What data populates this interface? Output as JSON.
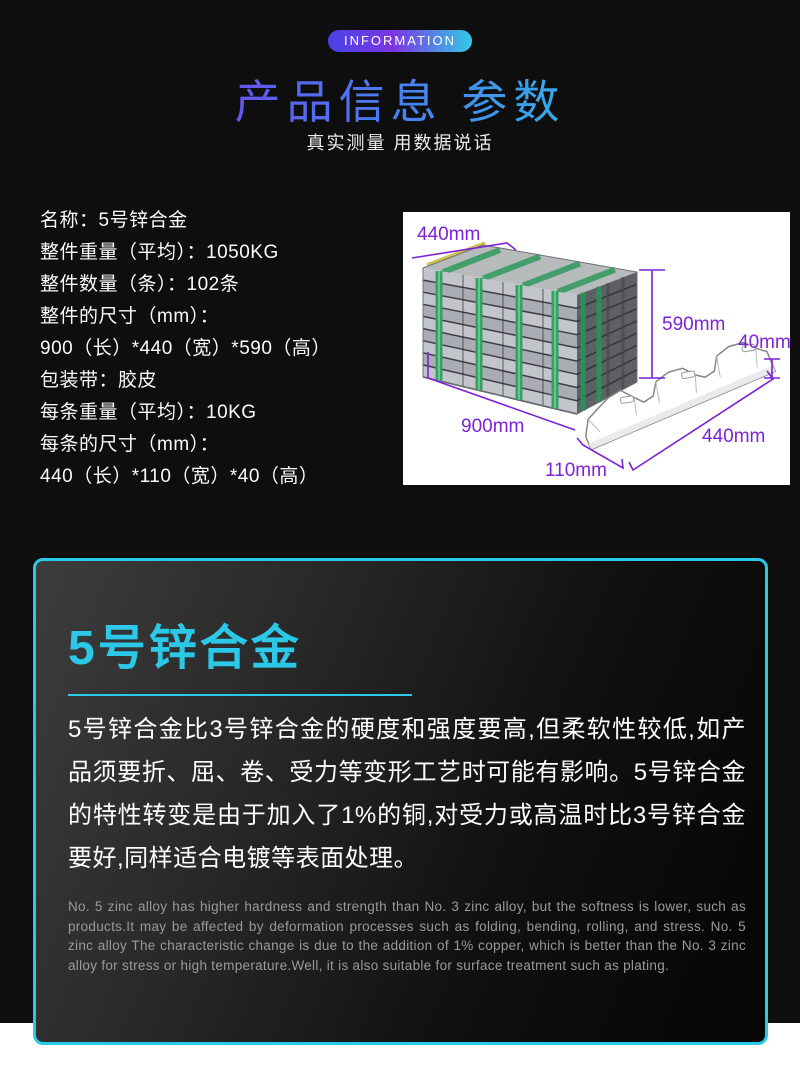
{
  "header": {
    "badge": "INFORMATION",
    "title": "产品信息 参数",
    "subtitle": "真实测量 用数据说话"
  },
  "specs": {
    "lines": [
      "名称：5号锌合金",
      "整件重量（平均）：1050KG",
      "整件数量（条）：102条",
      "整件的尺寸（mm）：",
      "900（长）*440（宽）*590（高）",
      "包装带：胶皮",
      "每条重量（平均）：10KG",
      "每条的尺寸（mm）：",
      "440（长）*110（宽）*40（高）"
    ]
  },
  "figure": {
    "labels": {
      "pack_width": "440mm",
      "pack_height": "590mm",
      "bar_height": "40mm",
      "pack_length": "900mm",
      "bar_length": "440mm",
      "bar_width": "110mm"
    }
  },
  "card": {
    "heading": "5号锌合金",
    "body_zh": "5号锌合金比3号锌合金的硬度和强度要高,但柔软性较低,如产品须要折、屈、卷、受力等变形工艺时可能有影响。5号锌合金的特性转变是由于加入了1%的铜,对受力或高温时比3号锌合金要好,同样适合电镀等表面处理。",
    "body_en": "No. 5 zinc alloy has higher hardness and strength than No. 3 zinc alloy, but the softness is lower, such as products.It may be affected by deformation processes such as folding, bending, rolling, and stress. No. 5 zinc alloy The characteristic change is due to the addition of 1% copper, which is better than the No. 3 zinc alloy for stress or high temperature.Well, it is also suitable for surface treatment such as plating."
  },
  "colors": {
    "accent_cyan": "#2bc8e8",
    "dimension_purple": "#7d22d8",
    "badge_gradient": [
      "#4743e5",
      "#7c35e2",
      "#31cbe6"
    ],
    "title_gradient": [
      "#8b2be6",
      "#4a7cf2",
      "#2ed3e9"
    ],
    "strap_green": "#35a164"
  }
}
